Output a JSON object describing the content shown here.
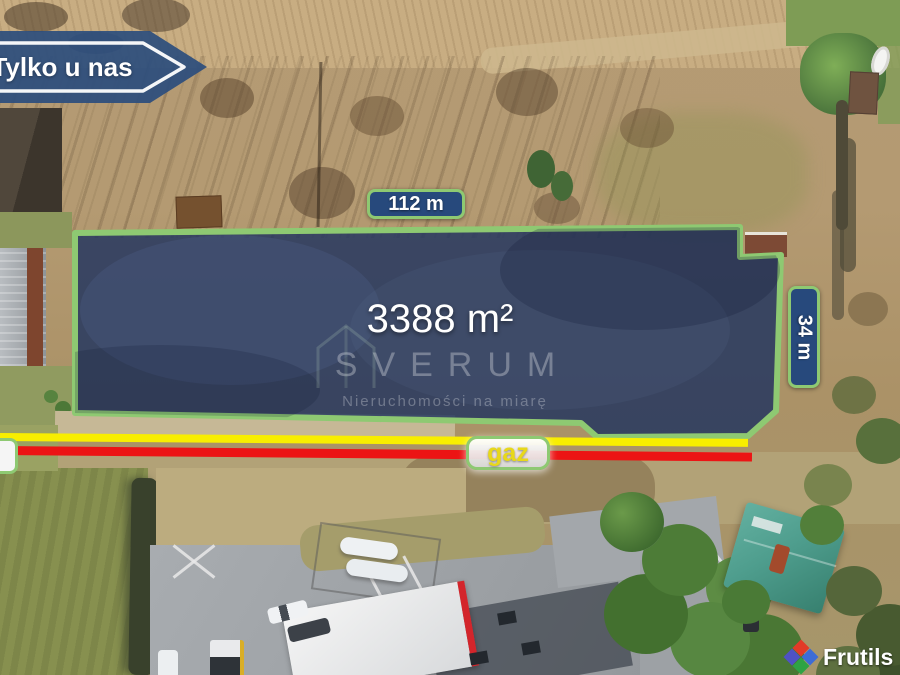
{
  "badge": {
    "label": "Tylko u nas"
  },
  "plot": {
    "area_label": "3388 m²",
    "width_label": "112 m",
    "depth_label": "34 m"
  },
  "utilities": {
    "gas_label": "gaz"
  },
  "watermark": {
    "brand": "SVERUM",
    "tagline": "Nieruchomości na miarę"
  },
  "credit": {
    "brand": "Frutils"
  },
  "colors": {
    "plot_fill": "#22365f",
    "plot_border": "#8ec972",
    "label_bg": "#27497c",
    "label_text": "#ffffff",
    "gas_line": "#f8ee00",
    "red_line": "#ec1414",
    "gaz_text": "#e8d81a",
    "badge_bg": "#2b4d7d",
    "logo_red": "#e23a28",
    "logo_indigo": "#4f52c4",
    "logo_blue": "#3d6cd6",
    "logo_green": "#2ea344"
  }
}
